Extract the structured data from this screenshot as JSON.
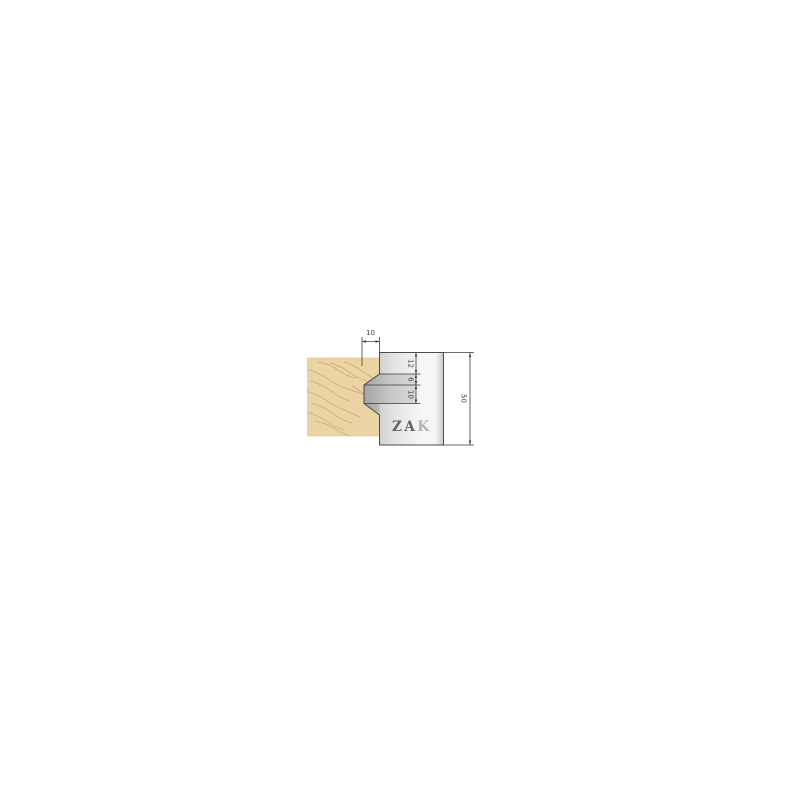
{
  "diagram": {
    "type": "technical-drawing-cutter-profile",
    "logo": {
      "za": "ZA",
      "k": "K"
    },
    "dimensions": {
      "top_width": "10",
      "step1": "12",
      "step2": "6",
      "step3": "10",
      "total_height": "50"
    },
    "colors": {
      "background": "#ffffff",
      "wood": "#ecd3a3",
      "wood_edge": "#dcc394",
      "wood_grain": "#bd9765",
      "metal_dark": "#b9b9b9",
      "metal_mid": "#e2e2e2",
      "metal_light": "#f6f6f6",
      "metal_edge_shade": "#c9c9c9",
      "outline": "#4d4d4d",
      "dimension_lines": "#3d3d3d",
      "logo_dark": "#616161",
      "logo_light": "#b2b2b2"
    }
  }
}
